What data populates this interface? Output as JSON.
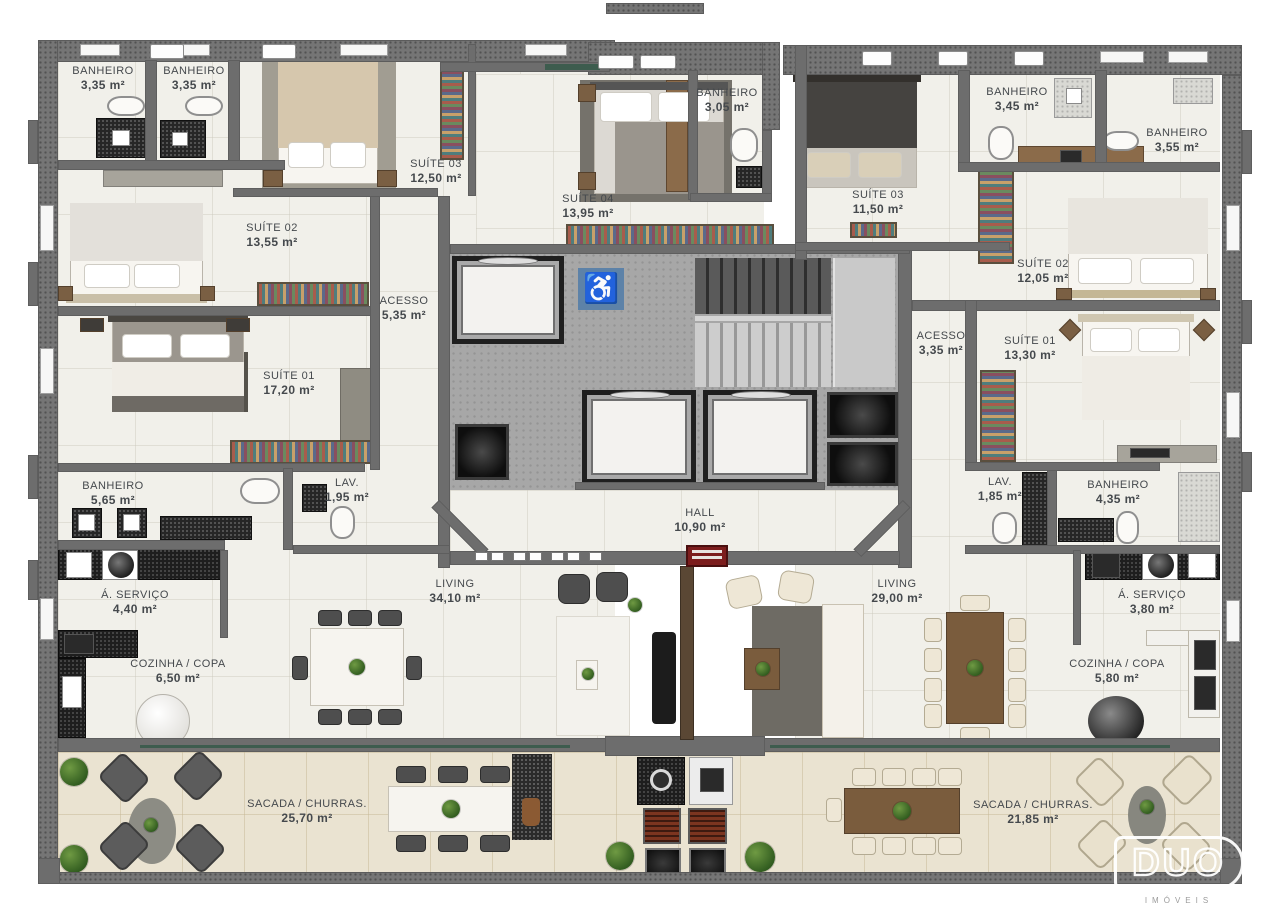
{
  "plan": {
    "rooms": [
      {
        "name": "BANHEIRO",
        "area": "3,35 m²"
      },
      {
        "name": "BANHEIRO",
        "area": "3,35 m²"
      },
      {
        "name": "SUÍTE 03",
        "area": "12,50 m²"
      },
      {
        "name": "SUÍTE 02",
        "area": "13,55 m²"
      },
      {
        "name": "SUÍTE 04",
        "area": "13,95 m²"
      },
      {
        "name": "BANHEIRO",
        "area": "3,05 m²"
      },
      {
        "name": "SUÍTE 03",
        "area": "11,50 m²"
      },
      {
        "name": "BANHEIRO",
        "area": "3,45 m²"
      },
      {
        "name": "BANHEIRO",
        "area": "3,55 m²"
      },
      {
        "name": "SUÍTE 02",
        "area": "12,05 m²"
      },
      {
        "name": "ACESSO",
        "area": "5,35 m²"
      },
      {
        "name": "ACESSO",
        "area": "3,35 m²"
      },
      {
        "name": "SUÍTE 01",
        "area": "17,20 m²"
      },
      {
        "name": "SUÍTE 01",
        "area": "13,30 m²"
      },
      {
        "name": "BANHEIRO",
        "area": "5,65 m²"
      },
      {
        "name": "LAV.",
        "area": "1,95 m²"
      },
      {
        "name": "LAV.",
        "area": "1,85 m²"
      },
      {
        "name": "BANHEIRO",
        "area": "4,35 m²"
      },
      {
        "name": "HALL",
        "area": "10,90 m²"
      },
      {
        "name": "Á. SERVIÇO",
        "area": "4,40 m²"
      },
      {
        "name": "Á. SERVIÇO",
        "area": "3,80 m²"
      },
      {
        "name": "LIVING",
        "area": "34,10 m²"
      },
      {
        "name": "LIVING",
        "area": "29,00 m²"
      },
      {
        "name": "COZINHA / COPA",
        "area": "6,50 m²"
      },
      {
        "name": "COZINHA / COPA",
        "area": "5,80 m²"
      },
      {
        "name": "SACADA / CHURRAS.",
        "area": "25,70 m²"
      },
      {
        "name": "SACADA / CHURRAS.",
        "area": "21,85 m²"
      }
    ],
    "signs": {
      "accessible_symbol": "♿"
    },
    "logo": {
      "brand": "DUO",
      "tagline": "IMÓVEIS"
    },
    "colors": {
      "exterior_wall": "#757575",
      "interior_wall": "#6d6d6d",
      "unit_floor": "#f1f0ea",
      "balcony_floor": "#eae3d1",
      "core_floor": "#a7a7a7",
      "accessible_blue": "#5d82a8",
      "glass_green": "#3d5c4e",
      "door_red": "#7c1d1d"
    }
  }
}
